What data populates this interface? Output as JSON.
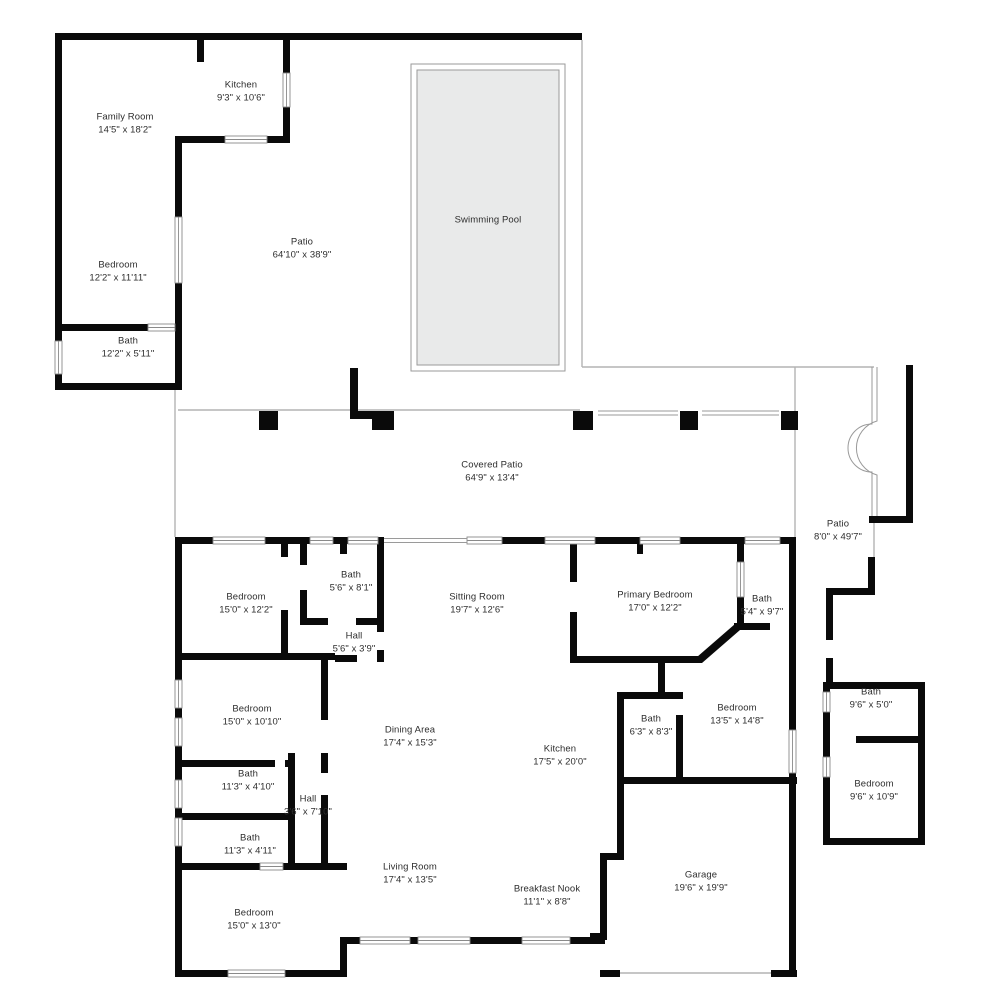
{
  "plan_title": "Single-family home floor plan",
  "colors": {
    "wall": "#0a0a0a",
    "thin_line": "#b3b3b3",
    "window_line": "#8a8a8a",
    "pool_fill": "#e9eaea",
    "text": "#2e2e2e",
    "background": "#ffffff"
  },
  "rooms": {
    "kitchen_upper": {
      "label": "Kitchen",
      "dims": "9'3\" x 10'6\""
    },
    "family_room": {
      "label": "Family Room",
      "dims": "14'5\" x 18'2\""
    },
    "bedroom_upper": {
      "label": "Bedroom",
      "dims": "12'2\" x 11'11\""
    },
    "bath_upper": {
      "label": "Bath",
      "dims": "12'2\" x 5'11\""
    },
    "patio_main": {
      "label": "Patio",
      "dims": "64'10\" x 38'9\""
    },
    "swimming_pool": {
      "label": "Swimming Pool",
      "dims": ""
    },
    "covered_patio": {
      "label": "Covered Patio",
      "dims": "64'9\" x 13'4\""
    },
    "patio_side": {
      "label": "Patio",
      "dims": "8'0\" x 49'7\""
    },
    "bedroom_nw": {
      "label": "Bedroom",
      "dims": "15'0\" x 12'2\""
    },
    "bath_small_n": {
      "label": "Bath",
      "dims": "5'6\" x 8'1\""
    },
    "hall_n": {
      "label": "Hall",
      "dims": "5'6\" x 3'9\""
    },
    "sitting_room": {
      "label": "Sitting Room",
      "dims": "19'7\" x 12'6\""
    },
    "primary_bedroom": {
      "label": "Primary Bedroom",
      "dims": "17'0\" x 12'2\""
    },
    "primary_bath": {
      "label": "Bath",
      "dims": "5'4\" x 9'7\""
    },
    "bedroom_w": {
      "label": "Bedroom",
      "dims": "15'0\" x 10'10\""
    },
    "bath_w1": {
      "label": "Bath",
      "dims": "11'3\" x 4'10\""
    },
    "hall_w": {
      "label": "Hall",
      "dims": "3'6\" x 7'10\""
    },
    "bath_w2": {
      "label": "Bath",
      "dims": "11'3\" x 4'11\""
    },
    "bedroom_sw": {
      "label": "Bedroom",
      "dims": "15'0\" x 13'0\""
    },
    "dining_area": {
      "label": "Dining Area",
      "dims": "17'4\" x 15'3\""
    },
    "kitchen_main": {
      "label": "Kitchen",
      "dims": "17'5\" x 20'0\""
    },
    "living_room": {
      "label": "Living Room",
      "dims": "17'4\" x 13'5\""
    },
    "breakfast_nook": {
      "label": "Breakfast Nook",
      "dims": "11'1\" x 8'8\""
    },
    "bath_c": {
      "label": "Bath",
      "dims": "6'3\" x 8'3\""
    },
    "bedroom_c": {
      "label": "Bedroom",
      "dims": "13'5\" x 14'8\""
    },
    "garage": {
      "label": "Garage",
      "dims": "19'6\" x 19'9\""
    },
    "bath_e": {
      "label": "Bath",
      "dims": "9'6\" x 5'0\""
    },
    "bedroom_e": {
      "label": "Bedroom",
      "dims": "9'6\" x 10'9\""
    }
  }
}
